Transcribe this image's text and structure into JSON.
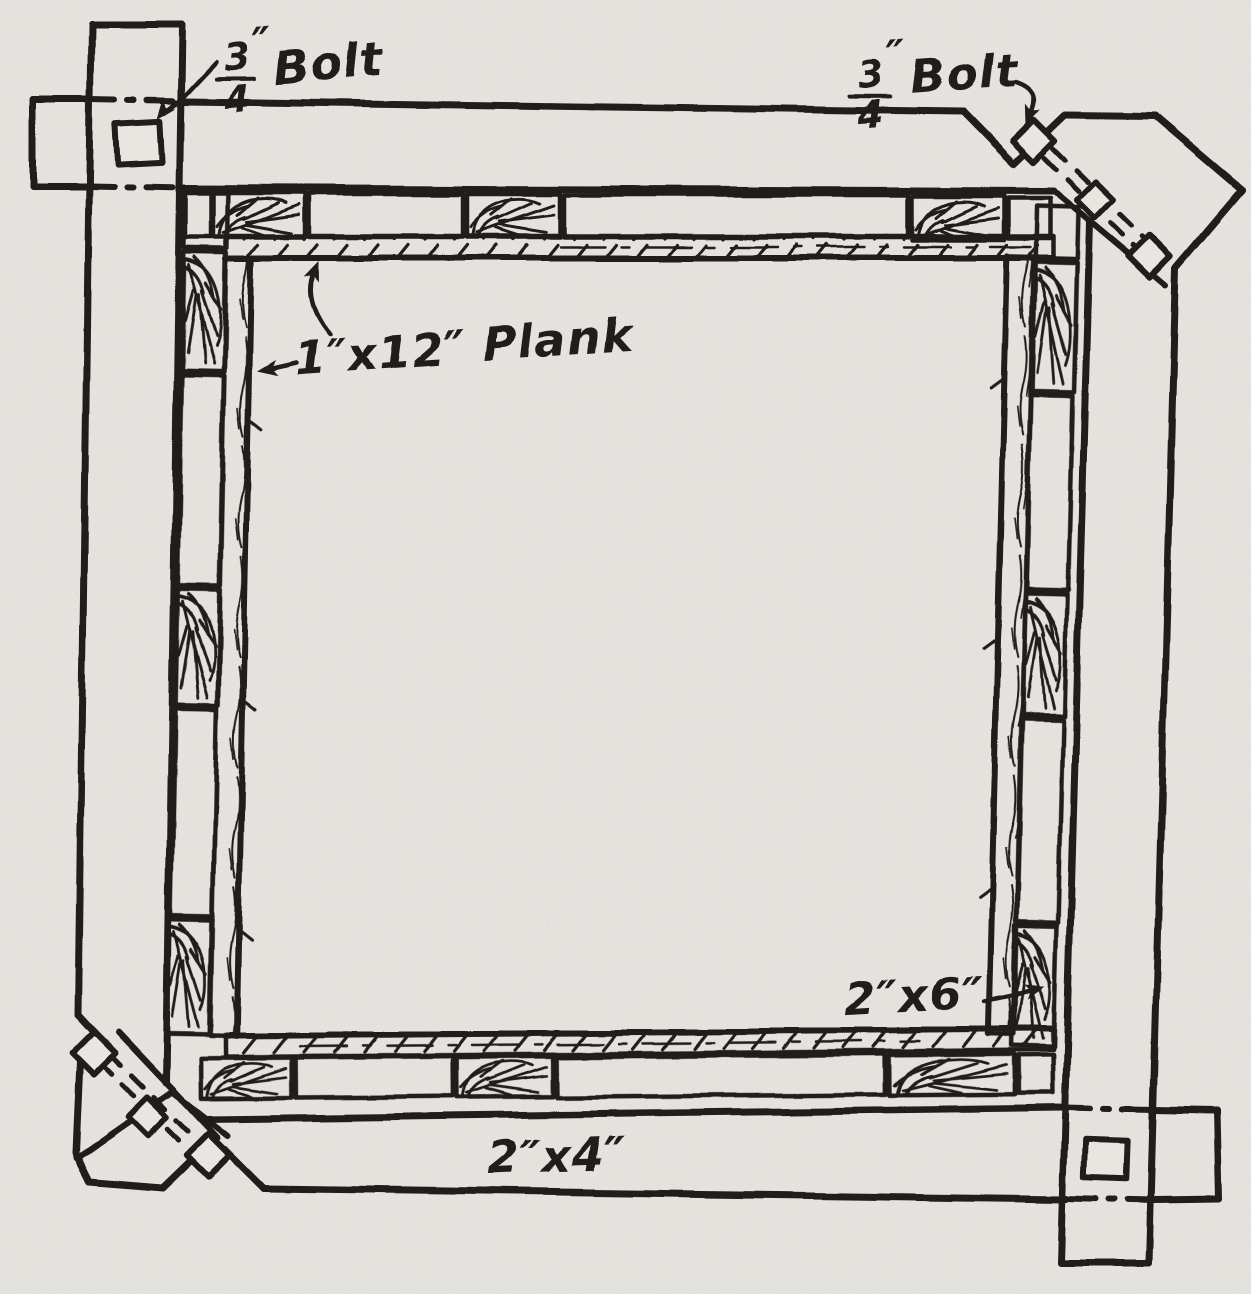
{
  "colors": {
    "ink": "#201d1a",
    "paper": "#e8e6e1"
  },
  "labels": {
    "top_left_bolt": {
      "numerator": "3",
      "denominator": "4",
      "prime": "″",
      "word": "Bolt"
    },
    "top_right_bolt": {
      "numerator": "3",
      "denominator": "4",
      "prime": "″",
      "word": "Bolt"
    },
    "plank": "1″x12″ Plank",
    "stud": "2″x6″",
    "rail": "2″x4″"
  }
}
